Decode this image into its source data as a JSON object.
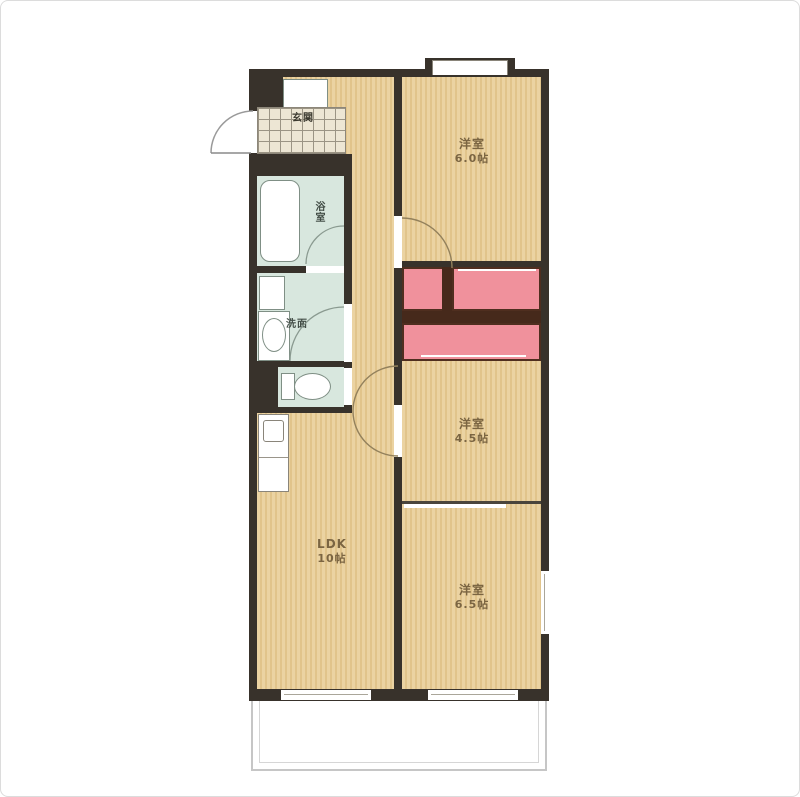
{
  "plan_type": "apartment-floor-plan",
  "rooms": {
    "western_6": {
      "name": "洋室",
      "size": "6.0帖"
    },
    "western_45": {
      "name": "洋室",
      "size": "4.5帖"
    },
    "western_65": {
      "name": "洋室",
      "size": "6.5帖"
    },
    "ldk": {
      "name": "LDK",
      "size": "10帖"
    },
    "bathroom": {
      "name": "浴室"
    },
    "washroom": {
      "name": "洗面"
    },
    "entrance": {
      "name": "玄関"
    }
  },
  "colors": {
    "wall": "#38322b",
    "floor": "#ebd3a2",
    "floor_stripe": "#e1c48b",
    "closet_fill": "#f0919c",
    "closet_border": "#4f2e1f",
    "wet_area": "#d8e7de",
    "entrance_tile": "#ede6d4",
    "balcony_line": "#c6c6c6"
  }
}
